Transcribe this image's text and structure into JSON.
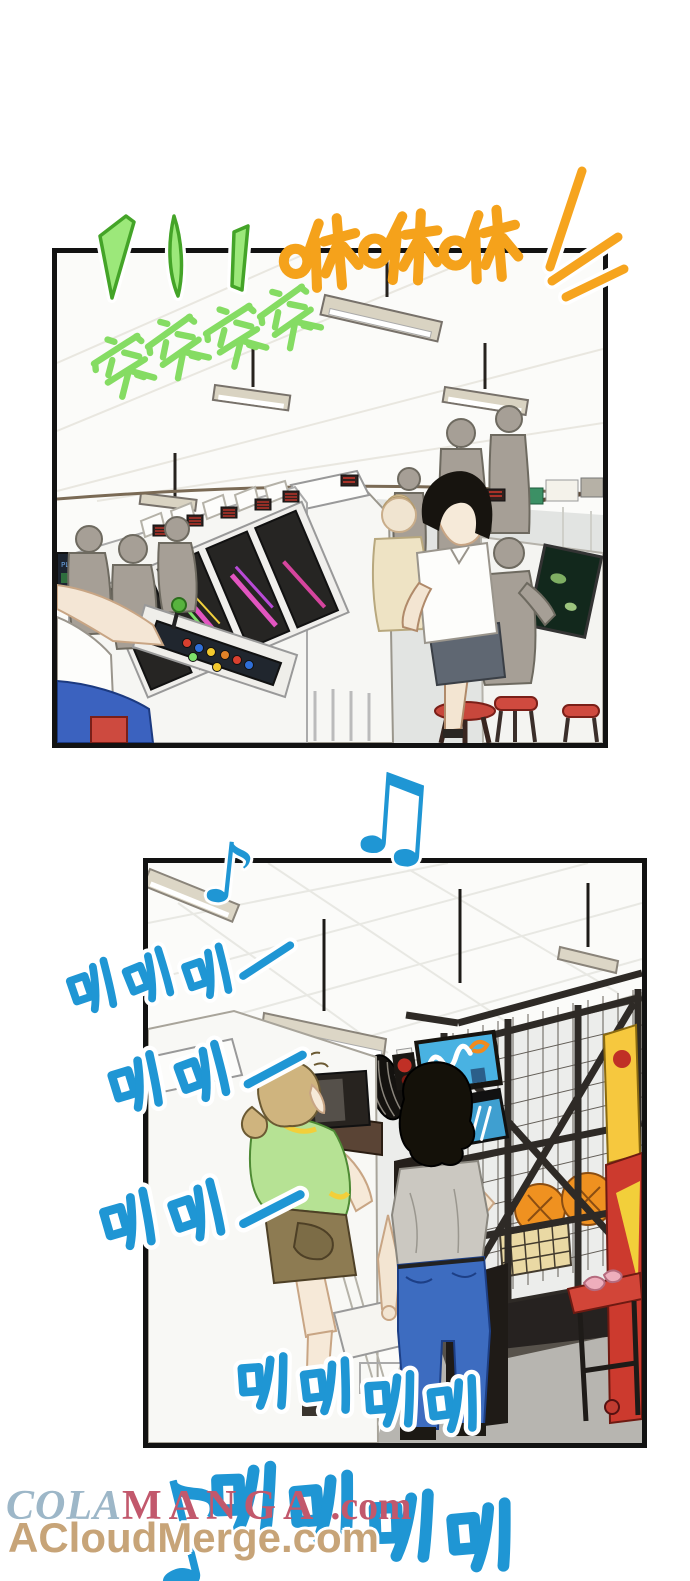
{
  "comic": {
    "panels": {
      "top": {
        "calendar_day": "5",
        "far_screen_text": "PLAYER"
      },
      "bottom": {}
    }
  },
  "sfx": {
    "machine_fire": {
      "text": "突突突突",
      "color": "#85DC63"
    },
    "whoosh": {
      "text": "咻咻咻",
      "color": "#F5A21B"
    },
    "horn_row_1": {
      "text": "叭叭叭—",
      "color": "#1F96D4"
    },
    "horn_row_2": {
      "text": "叭叭—",
      "color": "#1F96D4"
    },
    "horn_row_3": {
      "text": "叭叭—",
      "color": "#1F96D4"
    },
    "horn_row_4": {
      "text": "叭叭叭叭",
      "color": "#1F96D4"
    },
    "horn_row_5": {
      "text": "叭叭叭叭",
      "color": "#1F96D4"
    },
    "note_small": {
      "text": "♪",
      "color": "#1F96D4"
    },
    "note_beamed": {
      "text": "♫",
      "color": "#1F96D4"
    },
    "note_large": {
      "text": "♪",
      "color": "#1F96D4"
    }
  },
  "watermarks": {
    "colamanga": {
      "cola": "COLA",
      "manga": "MANGA",
      "suffix": " .com",
      "cola_color": "#9DB7C8",
      "manga_color": "#C2586C"
    },
    "acloudmerge": {
      "text": "ACloudMerge.com",
      "color": "#C7A478"
    }
  },
  "palette": {
    "panel_border": "#121212",
    "silhouette": "#A69F96",
    "stool_red": "#CD4A3F",
    "jeans_blue": "#3D6CC0",
    "shirt_green": "#B6E294",
    "basketball_orange": "#EF9120"
  }
}
